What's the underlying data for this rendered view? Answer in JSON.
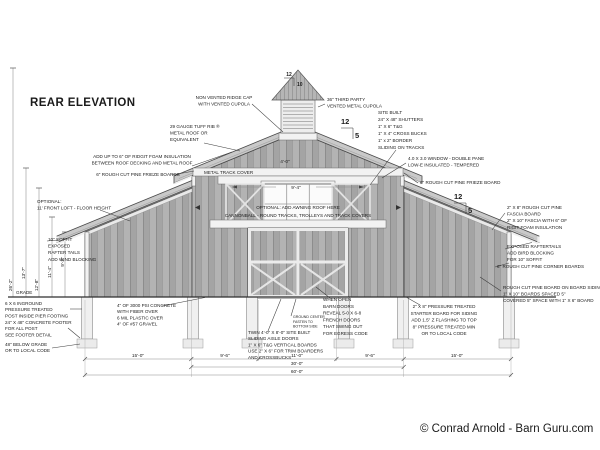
{
  "page": {
    "title": "REAR ELEVATION",
    "credit": "© Conrad Arnold - Barn Guru.com"
  },
  "pitch": {
    "main_rise": "12",
    "main_run": "5",
    "cupola_rise": "12",
    "cupola_run": "10"
  },
  "dimensions": {
    "bottom_row1": [
      "15'-0\"",
      "9'-6\"",
      "11'-0\"",
      "9'-6\"",
      "15'-0\""
    ],
    "bottom_row2": "30'-0\"",
    "bottom_row3": "60'-0\"",
    "heights": [
      "26'-2\"",
      "13'-7\"",
      "12'-8\"",
      "11'-4\"",
      "9'-2\""
    ],
    "loft_width": "9'-4\"",
    "loft_small": "4'-0\""
  },
  "annotations": {
    "ridge_cap": {
      "lines": [
        "NON VENTED RIDGE CAP",
        "WITH VENTED CUPOLA"
      ]
    },
    "cupola36": {
      "lines": [
        "36\" THIRD PARTY",
        "VENTED METAL CUPOLA"
      ]
    },
    "metal_roof": {
      "lines": [
        "29 GAUGE TUFF RIB ®",
        "METAL ROOF OR",
        "EQUIVALENT"
      ]
    },
    "foam": {
      "lines": [
        "ADD UP TO 6\" OF RIDGIT FOAM INSULATION",
        "BETWEEN ROOF DECKING AND METAL ROOF"
      ]
    },
    "frieze_left": {
      "lines": [
        "6\" ROUGH CUT PINE FRIEZE BOARDS"
      ]
    },
    "optional_loft": {
      "lines": [
        "OPTIONAL:",
        "11' FRONT LOFT - FLOOR HEIGHT"
      ]
    },
    "soffit_left": {
      "lines": [
        "10\" SOFFIT",
        "EXPOSED",
        "RAFTER TAILS",
        "ADD WIND BLOCKING"
      ]
    },
    "grade": {
      "lines": [
        "GRADE"
      ]
    },
    "post": {
      "lines": [
        "6 X 6 INGROUND",
        "PRESSURE TREATED",
        "POST INSIDE PIER FOOTING"
      ]
    },
    "footer": {
      "lines": [
        "24\" X 48\" CONCRETE FOOTER",
        "FOR ALL POST",
        "SEE FOOTER DETAIL"
      ]
    },
    "below_grade": {
      "lines": [
        "48\" BELOW GRADE",
        "OR TO LOCAL CODE"
      ]
    },
    "slab": {
      "lines": [
        "4\" OF 3000 PSI CONCRETE",
        "WITH FIBER OVER",
        "6 MIL PLASTIC OVER",
        "4\" OF #57 GRAVEL"
      ]
    },
    "track_cover": {
      "lines": [
        "METAL TRACK COVER"
      ]
    },
    "awning": {
      "lines": [
        "OPTIONAL: ADD AWNING ROOF HERE"
      ]
    },
    "cannonball": {
      "lines": [
        "CANNONBALL - ROUND TRACKS, TROLLEYS AND TRACK COVERS"
      ]
    },
    "shutters": {
      "lines": [
        "SITE BUILT",
        "24\" X 48\" SHUTTERS",
        "1\" X 6\" T&G",
        "1\" X 4\" CROSS BUCKS",
        "1\" x 2\" BORDER",
        "SLIDING ON TRACKS"
      ]
    },
    "window": {
      "lines": [
        "4.0 X 3.0 WINDOW - DOUBLE PANE",
        "LOW-E INSULATED - TEMPERED"
      ]
    },
    "frieze_right": {
      "lines": [
        "6\" ROUGH CUT PINE FRIEZE BOARD"
      ]
    },
    "fascia": {
      "lines": [
        "2\" X 8\" ROUGH CUT PINE",
        "FASCIA BOARD",
        "2\" X 10\" FASCIA WITH 6\" OF",
        "RIGIT FOAM INSULATION"
      ]
    },
    "rafter_right": {
      "lines": [
        "EXPOSED RAFTERTAILS",
        "ADD BIRD BLOCKING",
        "FOR 10\" SOFFIT"
      ]
    },
    "corner": {
      "lines": [
        "6\" ROUGH CUT PINE CORNER BOARDS"
      ]
    },
    "siding": {
      "lines": [
        "ROUGH CUT PINE BOARD ON BOARD SIDING",
        "1\" X 10\" BOARDS SPACED 5\"",
        "COVERED 5\" SPACE WITH 1\" X 6\" BOARD"
      ]
    },
    "starter": {
      "lines": [
        "2\" X 8\" PRESSURE TREATED",
        "STARTER BOARD FOR SIDING",
        "ADD 1.5\" Z FLASHING TO TOP",
        "8\" PRESSURE TREATED MIN",
        "OR TO LOCAL CODE"
      ]
    },
    "french": {
      "lines": [
        "WHEN OPEN",
        "BARN DOORS",
        "REVEAL 5-0 X 6-8",
        "FRENCH DOORS",
        "THAT SWING OUT",
        "FOR EGRESS CODE"
      ]
    },
    "aisle": {
      "lines": [
        "TWIN 4'-0\" X 8'-0\" SITE BUILT",
        "SLIDING AISLE DOORS",
        "1\" X 6\" T&G VERTICAL BOARDS",
        "USE 2\" X 6\" FOR TRIM BOARDERS",
        "AND CROSSBUCKS"
      ]
    },
    "center_note": {
      "lines": [
        "GROUND CENTER",
        "FASTEN TO",
        "BOTTOM SIDE"
      ]
    }
  },
  "colors": {
    "siding": "#b2b2b2",
    "roof": "#c9c9c9",
    "trim": "#f2f2f2",
    "line_dark": "#2e2e2e",
    "text": "#1b1b1b"
  }
}
